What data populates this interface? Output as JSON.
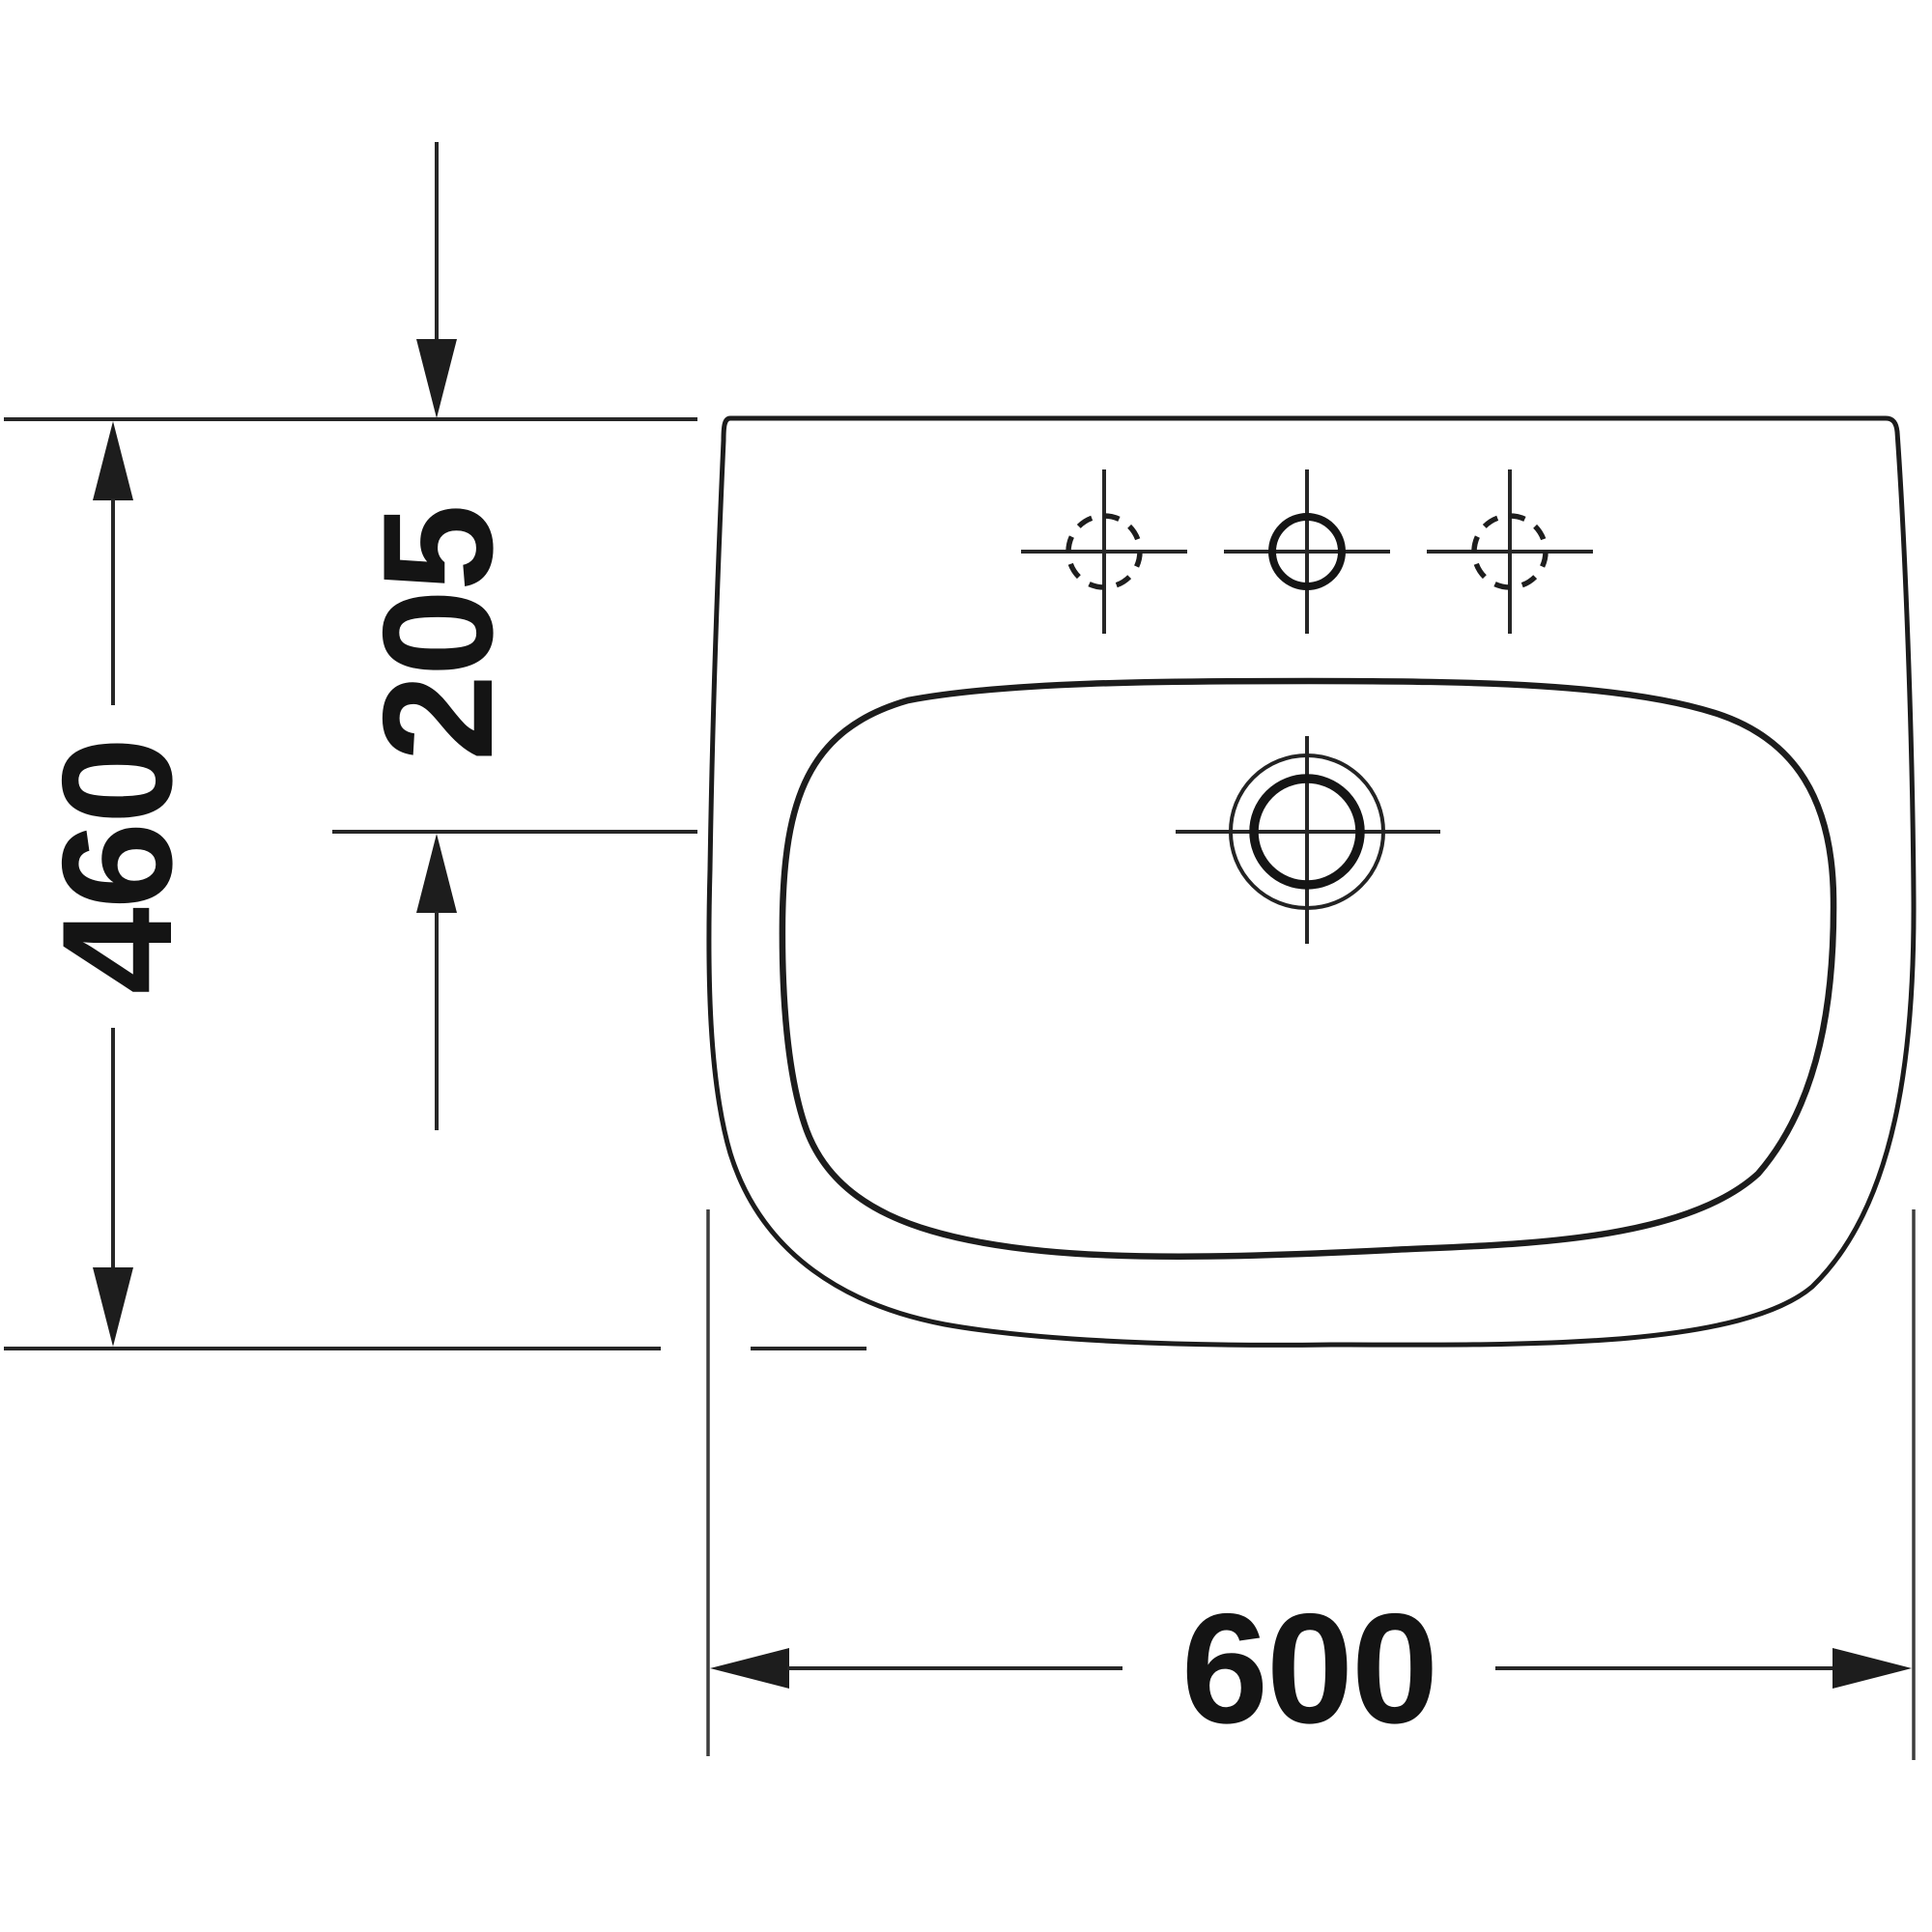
{
  "colors": {
    "background": "#ffffff",
    "line": "#262626",
    "text": "#141414"
  },
  "dims": {
    "width": "600",
    "depth": "460",
    "drain_offset": "205"
  }
}
